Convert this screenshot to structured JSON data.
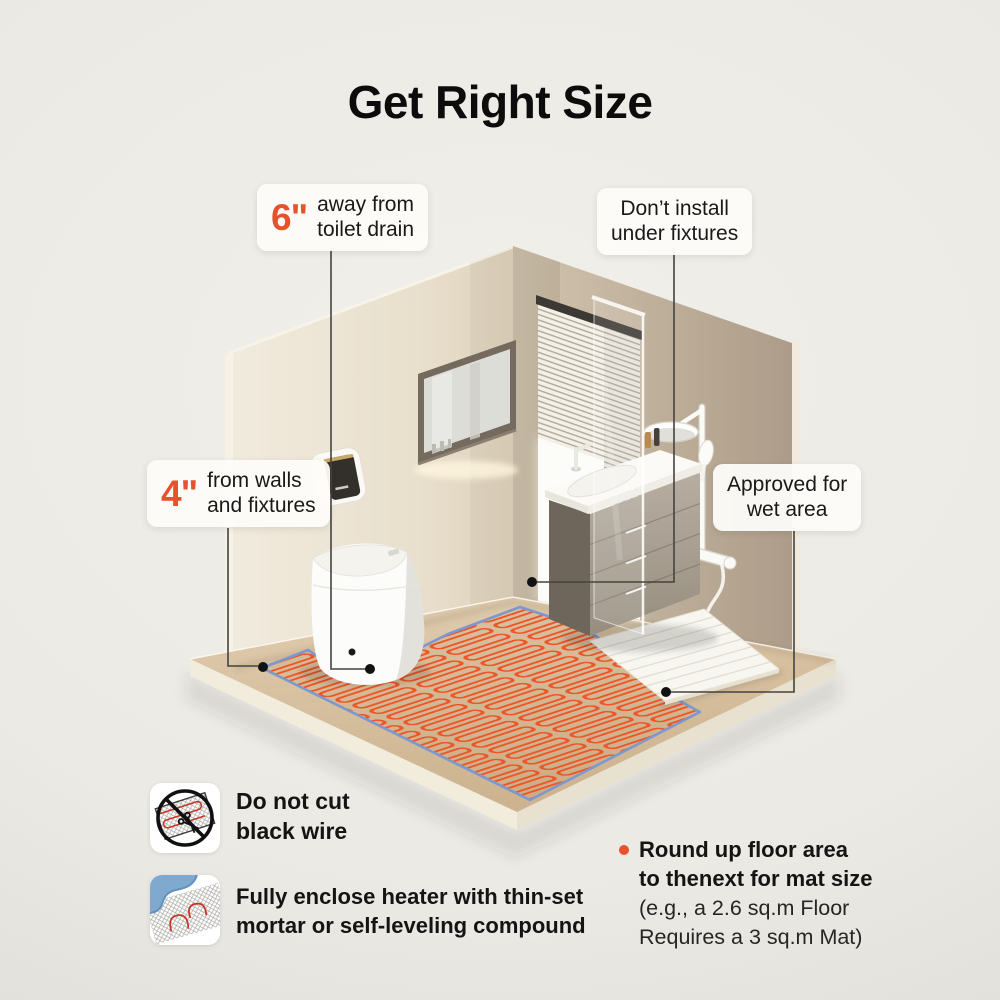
{
  "title": "Get Right Size",
  "accent_color": "#E8512B",
  "callouts": {
    "toilet_drain": {
      "number": "6\"",
      "line1": "away from",
      "line2": "toilet drain"
    },
    "walls": {
      "number": "4\"",
      "line1": "from walls",
      "line2": "and fixtures"
    },
    "fixtures": {
      "line1": "Don’t install",
      "line2": "under fixtures"
    },
    "wet_area": {
      "line1": "Approved for",
      "line2": "wet area"
    }
  },
  "notes": {
    "no_cut": {
      "icon": "no-cut-black-wire-icon",
      "line1": "Do not cut",
      "line2": "black wire"
    },
    "enclose": {
      "icon": "thin-set-mortar-icon",
      "line1": "Fully enclose heater with thin-set",
      "line2": "mortar or self-leveling compound"
    },
    "round_up": {
      "bold1": "Round up floor area",
      "bold2": "to thenext for mat size",
      "reg1": "(e.g., a 2.6 sq.m Floor",
      "reg2": "Requires a 3 sq.m Mat)"
    }
  },
  "scene": {
    "colors": {
      "heating_wire": "#EF5226",
      "mat_border": "#7D98CF",
      "left_wall": "#EAE2D3",
      "right_wall": "#BFB09C",
      "floor_wood": "#D9C3A2"
    }
  }
}
